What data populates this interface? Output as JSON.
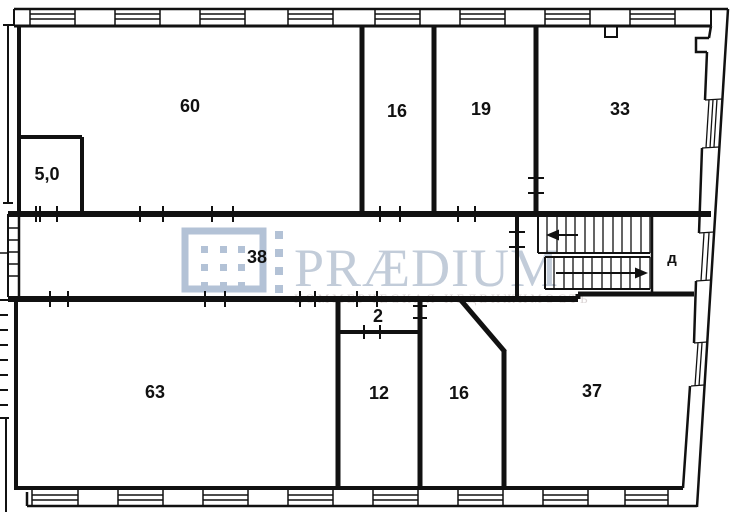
{
  "canvas": {
    "background": "#ffffff",
    "wall_color": "#111111",
    "label_color": "#111111"
  },
  "plan": {
    "type": "floor-plan",
    "rooms": [
      {
        "name": "room-60",
        "label": "60"
      },
      {
        "name": "room-5-0",
        "label": "5,0"
      },
      {
        "name": "room-16-top",
        "label": "16"
      },
      {
        "name": "room-19",
        "label": "19"
      },
      {
        "name": "room-33",
        "label": "33"
      },
      {
        "name": "corridor-38",
        "label": "38"
      },
      {
        "name": "stair-lobby-d",
        "label": "д"
      },
      {
        "name": "room-63",
        "label": "63"
      },
      {
        "name": "room-2",
        "label": "2"
      },
      {
        "name": "room-12",
        "label": "12"
      },
      {
        "name": "room-16-bottom",
        "label": "16"
      },
      {
        "name": "room-37",
        "label": "37"
      }
    ]
  },
  "watermark": {
    "brand": "PRÆDIUM",
    "tagline": "КОММЕРЧЕСКАЯ НЕДВИЖИМОСТЬ",
    "brand_color": "#c2ccd9",
    "tagline_color": "#dbd4d4",
    "logo_color": "#b3c2d6"
  }
}
